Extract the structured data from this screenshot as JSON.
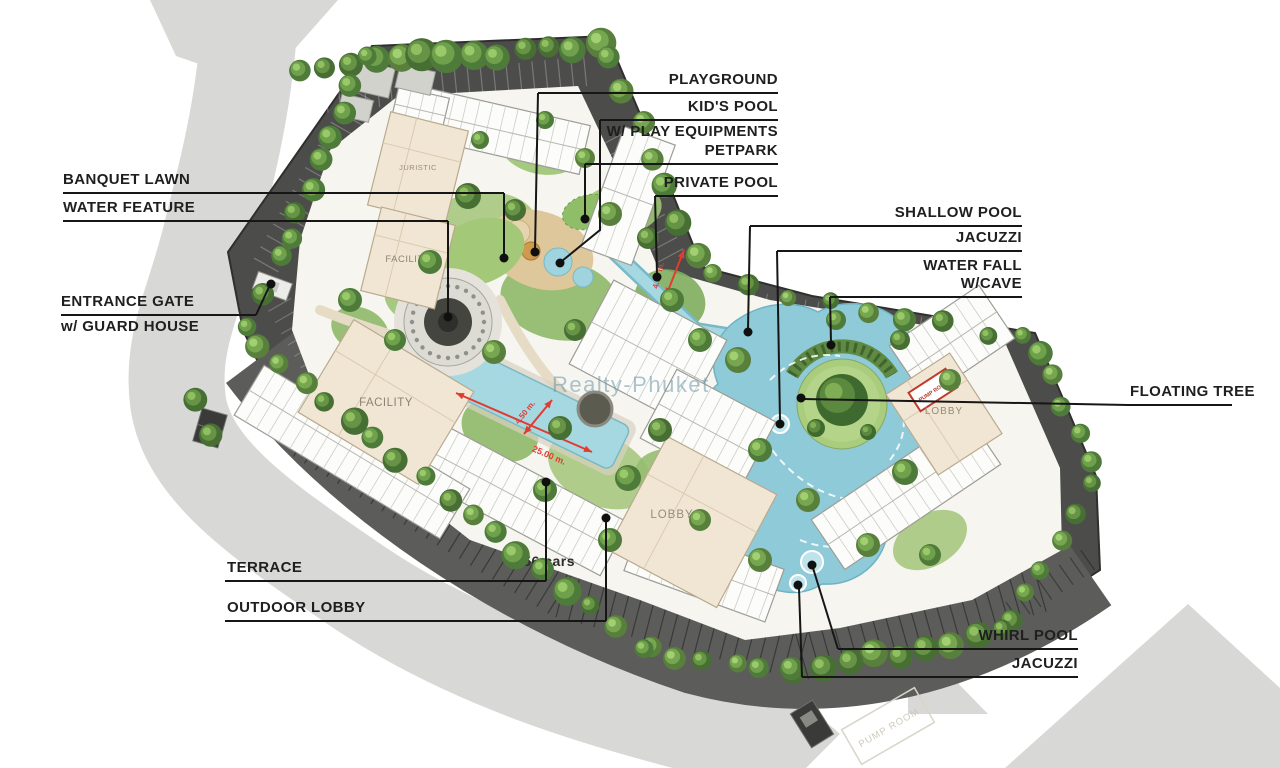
{
  "watermark": {
    "text": "Realty-Phuket"
  },
  "plan_labels": {
    "juristic": "JURISTIC",
    "facility_upper": "FACILITY",
    "facility_lower": "FACILITY",
    "lobby_central": "LOBBY",
    "lobby_east": "LOBBY",
    "pump_room": "PUMP ROOM",
    "pump_room_ghost": "PUMP ROOM",
    "parking_capacity": "156 cars"
  },
  "dimensions": {
    "pool_length": "25.00 m.",
    "pool_width": "4.50 m.",
    "entry_ramp": "4.50 m."
  },
  "colors": {
    "podium": "#4c4c4b",
    "parking_lot": "#5c5c5a",
    "road": "#d8d8d7",
    "pool": "#a5d8e1",
    "lagoon": "#8ecad7",
    "lawn": "#a3c878",
    "sand": "#ddc79b",
    "beige_building": "#f1e6d4",
    "label_ink": "#1f1f1f",
    "dimension_red": "#e03c31"
  },
  "callouts": [
    {
      "id": "playground",
      "lines": [
        "PLAYGROUND"
      ]
    },
    {
      "id": "kids_pool",
      "lines": [
        "KID'S POOL",
        "W/ PLAY EQUIPMENTS"
      ]
    },
    {
      "id": "petpark",
      "lines": [
        "PETPARK"
      ]
    },
    {
      "id": "private_pool",
      "lines": [
        "PRIVATE POOL"
      ]
    },
    {
      "id": "shallow_pool",
      "lines": [
        "SHALLOW POOL"
      ]
    },
    {
      "id": "jacuzzi_top",
      "lines": [
        "JACUZZI"
      ]
    },
    {
      "id": "water_fall",
      "lines": [
        "WATER FALL",
        "W/CAVE"
      ]
    },
    {
      "id": "floating_tree",
      "lines": [
        "FLOATING TREE"
      ]
    },
    {
      "id": "banquet_lawn",
      "lines": [
        "BANQUET LAWN"
      ]
    },
    {
      "id": "water_feature",
      "lines": [
        "WATER FEATURE"
      ]
    },
    {
      "id": "entrance_gate",
      "lines": [
        "ENTRANCE GATE",
        "w/ GUARD HOUSE"
      ]
    },
    {
      "id": "terrace",
      "lines": [
        "TERRACE"
      ]
    },
    {
      "id": "outdoor_lobby",
      "lines": [
        "OUTDOOR LOBBY"
      ]
    },
    {
      "id": "whirl_pool",
      "lines": [
        "WHIRL POOL"
      ]
    },
    {
      "id": "jacuzzi_bottom",
      "lines": [
        "JACUZZI"
      ]
    }
  ]
}
